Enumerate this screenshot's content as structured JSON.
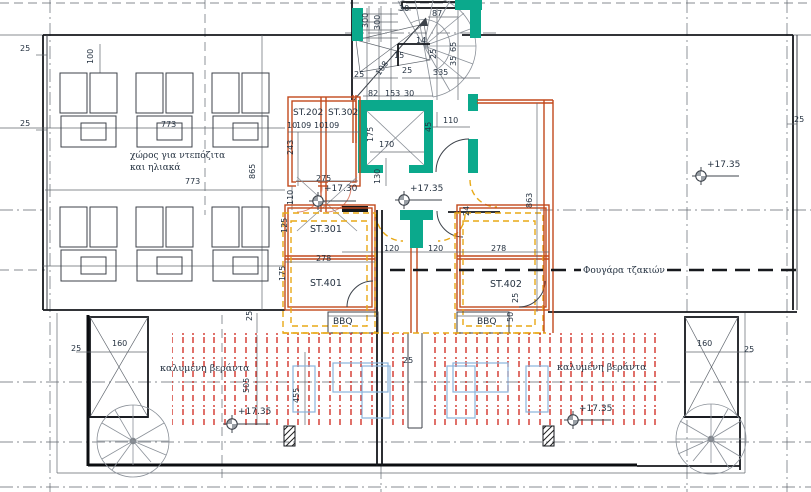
{
  "drawing": {
    "type": "roof-level architectural floor plan",
    "colors": {
      "teal": "#0ba98c",
      "orange": "#c2491d",
      "yellow": "#e8a917",
      "red_hatch": "#cf2419",
      "blue_furniture": "#8ab4dc",
      "ink": "#253241"
    }
  },
  "labels": {
    "storage_line1": "χώρος για ντεπόζιτα",
    "storage_line2": "και ηλιακά",
    "veranda_left": "καλυμένη βεράντα",
    "veranda_right": "καλυμένη βεράντα",
    "chimney": "Φουγάρα τζακιών",
    "bbq_left": "BBQ",
    "bbq_right": "BBQ"
  },
  "rooms": {
    "st202": "ST.202",
    "st302": "ST.302",
    "st301": "ST.301",
    "st401": "ST.401",
    "st402": "ST.402"
  },
  "levels": {
    "upper_landing": "+17.30",
    "core": "+17.35",
    "roof_right": "+17.35",
    "veranda_left": "+17.35",
    "veranda_right": "+17.35"
  },
  "dims": [
    "25",
    "25",
    "100",
    "773",
    "773",
    "865",
    "243",
    "10",
    "109",
    "10",
    "109",
    "300",
    "300",
    "30",
    "87",
    "25",
    "108",
    "25",
    "335",
    "82",
    "153",
    "30",
    "15",
    "14",
    "65",
    "35",
    "25",
    "175",
    "170",
    "110",
    "45",
    "130",
    "110",
    "275",
    "125",
    "278",
    "175",
    "120",
    "120",
    "278",
    "863",
    "24",
    "25",
    "50",
    "25",
    "505",
    "455",
    "160",
    "25",
    "160",
    "25",
    "25",
    "25"
  ]
}
